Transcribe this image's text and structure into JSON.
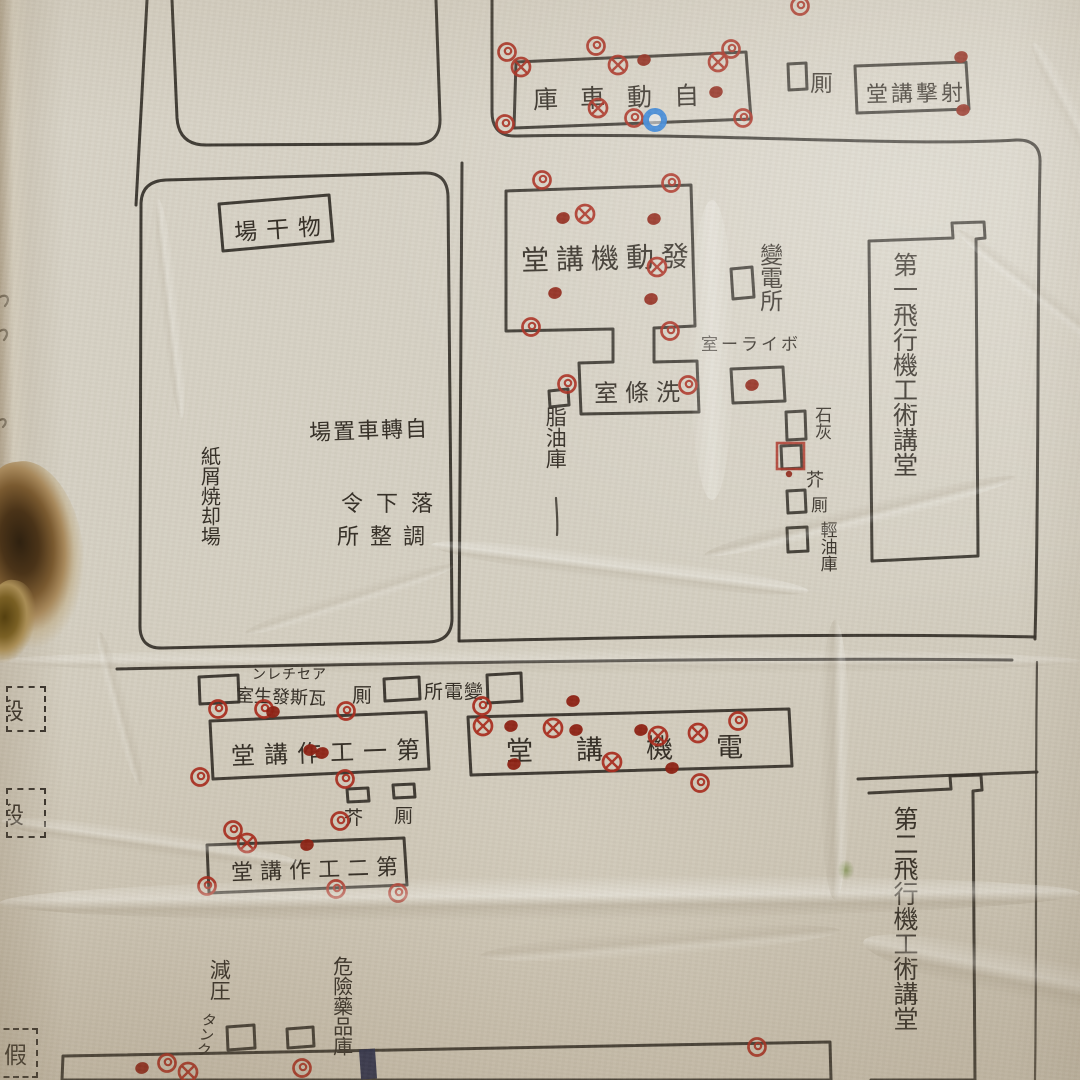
{
  "colors": {
    "paper": "#d6d0c3",
    "ink": "#2e2922",
    "red": "#a8281a",
    "red_dark": "#8c1d10",
    "blue": "#2f7fd6",
    "navy": "#232848"
  },
  "map": {
    "labels": {
      "garage": "庫車動自",
      "toilet_top": "厠",
      "shooting_hall": "堂講撃射",
      "drying_area": "場干物",
      "engine_hall": "堂講機動發",
      "substation_upper": "變電所",
      "boiler_room": "室ーライボ",
      "washing_room": "室條洗",
      "oil_store": "脂油庫",
      "bicycle_parking": "場置車轉自",
      "parachute_row1": "令下落",
      "parachute_row2": "所整調",
      "incinerator": "紙屑焼却場",
      "lime": "石灰",
      "garbage_right": "芥",
      "toilet_right": "厠",
      "light_oil": "輕油庫",
      "hall_no1": "第一飛行機工術講堂",
      "acetylene": "ンレチセア",
      "gas_room": "室生發斯瓦",
      "toilet_mid": "厠",
      "substation_lower": "所電變",
      "workshop1": "堂講作工一第",
      "electric_hall": "堂講機電",
      "garbage_mid": "芥",
      "toilet_mid2": "厠",
      "workshop2": "堂講作工二第",
      "decompression": "減圧",
      "tank": "タンク",
      "danger_store": "危險藥品庫",
      "hall_no2": "第二飛行機工術講堂",
      "edge_label_1": "段",
      "edge_label_2": "段",
      "edge_label_3": "假"
    }
  },
  "marks": [
    {
      "t": "spiral",
      "x": 507,
      "y": 52
    },
    {
      "t": "spiral",
      "x": 596,
      "y": 46
    },
    {
      "t": "spiral",
      "x": 731,
      "y": 49
    },
    {
      "t": "spiral",
      "x": 634,
      "y": 118
    },
    {
      "t": "spiral",
      "x": 743,
      "y": 118
    },
    {
      "t": "spiral",
      "x": 505,
      "y": 124
    },
    {
      "t": "spiral",
      "x": 800,
      "y": 6
    },
    {
      "t": "cross",
      "x": 521,
      "y": 67
    },
    {
      "t": "cross",
      "x": 618,
      "y": 65
    },
    {
      "t": "cross",
      "x": 718,
      "y": 62
    },
    {
      "t": "cross",
      "x": 598,
      "y": 108
    },
    {
      "t": "dot",
      "x": 644,
      "y": 60
    },
    {
      "t": "dot",
      "x": 716,
      "y": 92
    },
    {
      "t": "blue",
      "x": 655,
      "y": 120
    },
    {
      "t": "dot",
      "x": 961,
      "y": 57
    },
    {
      "t": "dot",
      "x": 963,
      "y": 110
    },
    {
      "t": "spiral",
      "x": 542,
      "y": 180
    },
    {
      "t": "spiral",
      "x": 671,
      "y": 183
    },
    {
      "t": "dot",
      "x": 563,
      "y": 218
    },
    {
      "t": "cross",
      "x": 585,
      "y": 214
    },
    {
      "t": "dot",
      "x": 654,
      "y": 219
    },
    {
      "t": "cross",
      "x": 657,
      "y": 267
    },
    {
      "t": "dot",
      "x": 555,
      "y": 293
    },
    {
      "t": "dot",
      "x": 651,
      "y": 299
    },
    {
      "t": "spiral",
      "x": 531,
      "y": 327
    },
    {
      "t": "spiral",
      "x": 670,
      "y": 331
    },
    {
      "t": "spiral",
      "x": 567,
      "y": 384
    },
    {
      "t": "spiral",
      "x": 688,
      "y": 385
    },
    {
      "t": "dot",
      "x": 752,
      "y": 385
    },
    {
      "t": "square",
      "x": 791,
      "y": 456
    },
    {
      "t": "dot_s",
      "x": 789,
      "y": 474
    },
    {
      "t": "spiral",
      "x": 218,
      "y": 709
    },
    {
      "t": "spiral",
      "x": 264,
      "y": 709
    },
    {
      "t": "dot",
      "x": 273,
      "y": 712
    },
    {
      "t": "spiral",
      "x": 346,
      "y": 711
    },
    {
      "t": "spiral",
      "x": 482,
      "y": 706
    },
    {
      "t": "dot",
      "x": 310,
      "y": 750
    },
    {
      "t": "dot",
      "x": 322,
      "y": 753
    },
    {
      "t": "spiral",
      "x": 200,
      "y": 777
    },
    {
      "t": "spiral",
      "x": 345,
      "y": 779
    },
    {
      "t": "spiral",
      "x": 340,
      "y": 821
    },
    {
      "t": "dot",
      "x": 573,
      "y": 701
    },
    {
      "t": "cross",
      "x": 483,
      "y": 726
    },
    {
      "t": "dot",
      "x": 511,
      "y": 726
    },
    {
      "t": "cross",
      "x": 553,
      "y": 728
    },
    {
      "t": "dot",
      "x": 576,
      "y": 730
    },
    {
      "t": "dot",
      "x": 641,
      "y": 730
    },
    {
      "t": "cross",
      "x": 658,
      "y": 736
    },
    {
      "t": "cross",
      "x": 698,
      "y": 733
    },
    {
      "t": "spiral",
      "x": 738,
      "y": 721
    },
    {
      "t": "cross",
      "x": 612,
      "y": 762
    },
    {
      "t": "dot",
      "x": 514,
      "y": 764
    },
    {
      "t": "dot",
      "x": 672,
      "y": 768
    },
    {
      "t": "spiral",
      "x": 700,
      "y": 783
    },
    {
      "t": "spiral",
      "x": 233,
      "y": 830
    },
    {
      "t": "cross",
      "x": 247,
      "y": 843
    },
    {
      "t": "dot",
      "x": 307,
      "y": 845
    },
    {
      "t": "spiral",
      "x": 207,
      "y": 886
    },
    {
      "t": "spiral",
      "x": 336,
      "y": 889
    },
    {
      "t": "spiral",
      "x": 398,
      "y": 893
    },
    {
      "t": "spiral",
      "x": 167,
      "y": 1063
    },
    {
      "t": "dot",
      "x": 142,
      "y": 1068
    },
    {
      "t": "cross",
      "x": 188,
      "y": 1072
    },
    {
      "t": "spiral",
      "x": 302,
      "y": 1068
    },
    {
      "t": "spiral",
      "x": 757,
      "y": 1047
    },
    {
      "t": "navy",
      "x": 368,
      "y": 1064
    }
  ]
}
